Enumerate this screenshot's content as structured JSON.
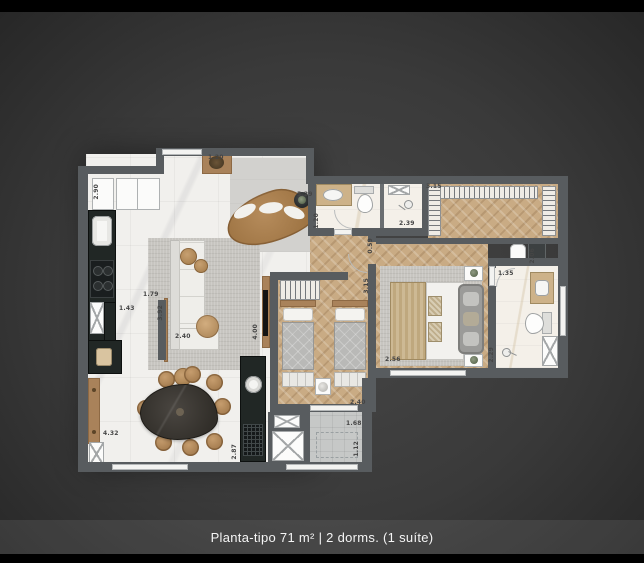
{
  "caption": "Planta-tipo 71 m² | 2 dorms. (1 suíte)",
  "colors": {
    "wall": "#585c5f",
    "wood": "#a9825a",
    "wood_floor": "#c9ab84",
    "marble": "#f1f0ed",
    "counter": "#212725",
    "rug": "#c7c5c0",
    "caption": "#f5f5f5"
  },
  "labels": [
    {
      "text": "2.90",
      "x": 94,
      "y": 184,
      "rot": true
    },
    {
      "text": "1.20",
      "x": 208,
      "y": 155,
      "rot": false
    },
    {
      "text": "5.29",
      "x": 297,
      "y": 192,
      "rot": false
    },
    {
      "text": "1.20",
      "x": 314,
      "y": 213,
      "rot": true
    },
    {
      "text": "1.79",
      "x": 143,
      "y": 292,
      "rot": false
    },
    {
      "text": "1.43",
      "x": 119,
      "y": 306,
      "rot": false
    },
    {
      "text": "3.92",
      "x": 158,
      "y": 305,
      "rot": true
    },
    {
      "text": "2.40",
      "x": 175,
      "y": 334,
      "rot": false
    },
    {
      "text": "4.00",
      "x": 253,
      "y": 324,
      "rot": true
    },
    {
      "text": "4.32",
      "x": 103,
      "y": 431,
      "rot": false
    },
    {
      "text": "2.87",
      "x": 232,
      "y": 444,
      "rot": true
    },
    {
      "text": "2.39",
      "x": 399,
      "y": 221,
      "rot": false
    },
    {
      "text": "3.15",
      "x": 426,
      "y": 184,
      "rot": false
    },
    {
      "text": "0.59",
      "x": 368,
      "y": 238,
      "rot": true
    },
    {
      "text": "3.15",
      "x": 364,
      "y": 278,
      "rot": true
    },
    {
      "text": "2.06",
      "x": 530,
      "y": 248,
      "rot": true
    },
    {
      "text": "1.35",
      "x": 498,
      "y": 271,
      "rot": false
    },
    {
      "text": "2.29",
      "x": 489,
      "y": 347,
      "rot": true
    },
    {
      "text": "2.56",
      "x": 385,
      "y": 357,
      "rot": false
    },
    {
      "text": "2.40",
      "x": 350,
      "y": 400,
      "rot": false
    },
    {
      "text": "1.68",
      "x": 346,
      "y": 421,
      "rot": false
    },
    {
      "text": "1.12",
      "x": 354,
      "y": 441,
      "rot": true
    }
  ]
}
